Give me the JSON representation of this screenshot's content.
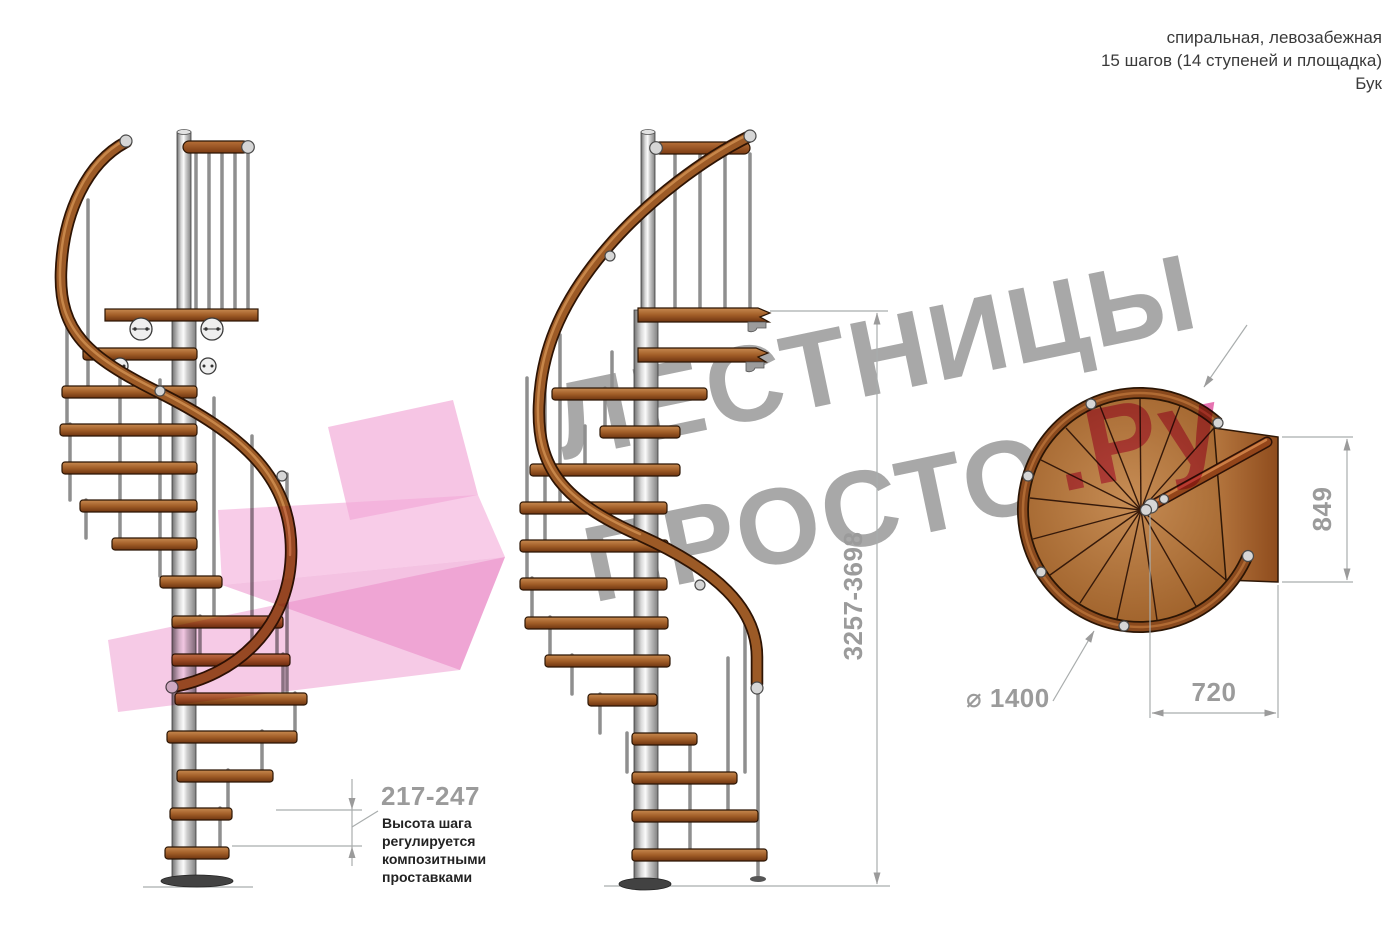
{
  "header": {
    "line1": "спиральная, левозабежная",
    "line2": "15 шагов (14 ступеней и площадка)",
    "line3": "Бук"
  },
  "watermark": {
    "line1": "ЛЕСТНИЦЫ",
    "line2": "ПРОСТО",
    "suffix": ".Ру",
    "gray_color": "#a8a8a8",
    "pink_color": "#e0519e"
  },
  "dimensions": {
    "total_height": "3257-3698",
    "step_height": "217-247",
    "landing_side": "849",
    "landing_width": "720",
    "diameter": "⌀ 1400"
  },
  "annotation": {
    "line1": "Высота шага",
    "line2": "регулируется",
    "line3": "композитными",
    "line4": "проставками"
  },
  "colors": {
    "wood": "#a05c28",
    "rail": "#8a4a1e",
    "pole": "#c9c9c9",
    "dimension_text": "#9b9b9b",
    "annotation_text": "#222222"
  }
}
